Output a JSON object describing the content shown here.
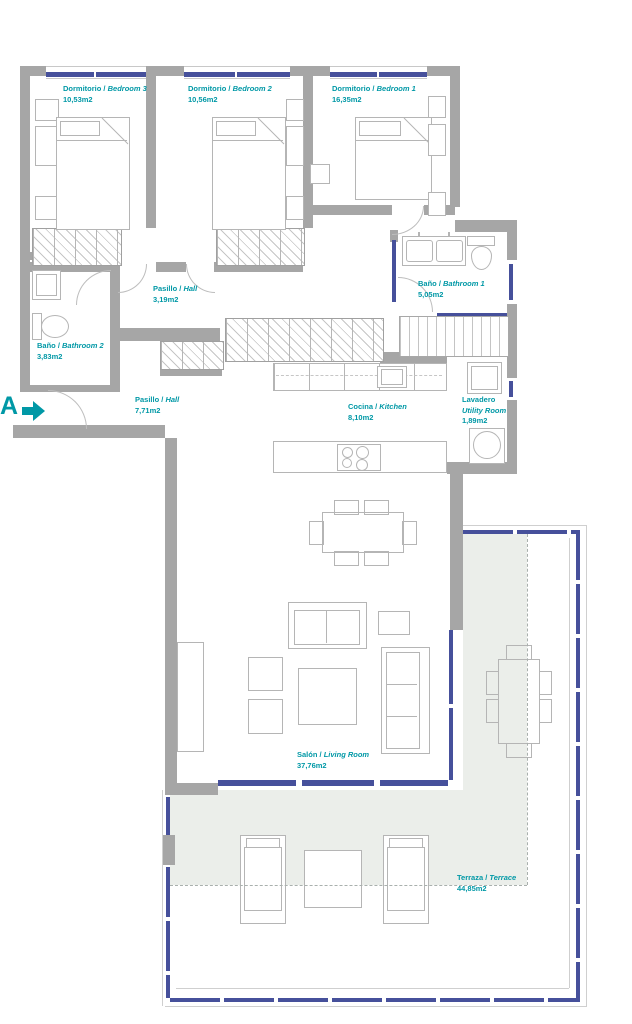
{
  "colors": {
    "accent": "#0098a6",
    "window": "#46509b",
    "wall": "#a6a6a6",
    "line": "#b5b5b5",
    "shade": "#ebeeea",
    "dash": "#a9b0ad"
  },
  "entrance": {
    "letter": "A"
  },
  "rooms": {
    "bedroom3": {
      "name_es": "Dormitorio",
      "sep": " / ",
      "name_en": "Bedroom 3",
      "area": "10,53m2"
    },
    "bedroom2": {
      "name_es": "Dormitorio",
      "sep": " / ",
      "name_en": "Bedroom 2",
      "area": "10,56m2"
    },
    "bedroom1": {
      "name_es": "Dormitorio",
      "sep": " / ",
      "name_en": "Bedroom 1",
      "area": "16,35m2"
    },
    "hall1": {
      "name_es": "Pasillo",
      "sep": " / ",
      "name_en": "Hall",
      "area": "3,19m2"
    },
    "bathroom1": {
      "name_es": "Baño",
      "sep": " / ",
      "name_en": "Bathroom 1",
      "area": "5,05m2"
    },
    "bathroom2": {
      "name_es": "Baño",
      "sep": " / ",
      "name_en": "Bathroom 2",
      "area": "3,83m2"
    },
    "hall2": {
      "name_es": "Pasillo",
      "sep": " / ",
      "name_en": "Hall",
      "area": "7,71m2"
    },
    "kitchen": {
      "name_es": "Cocina",
      "sep": " / ",
      "name_en": "Kitchen",
      "area": "8,10m2"
    },
    "utility": {
      "name_es": "Lavadero",
      "sep": "",
      "name_en": "Utility Room",
      "area": "1,89m2"
    },
    "living": {
      "name_es": "Salón",
      "sep": " / ",
      "name_en": "Living Room",
      "area": "37,76m2"
    },
    "terrace": {
      "name_es": "Terraza",
      "sep": " / ",
      "name_en": "Terrace",
      "area": "44,85m2"
    }
  }
}
